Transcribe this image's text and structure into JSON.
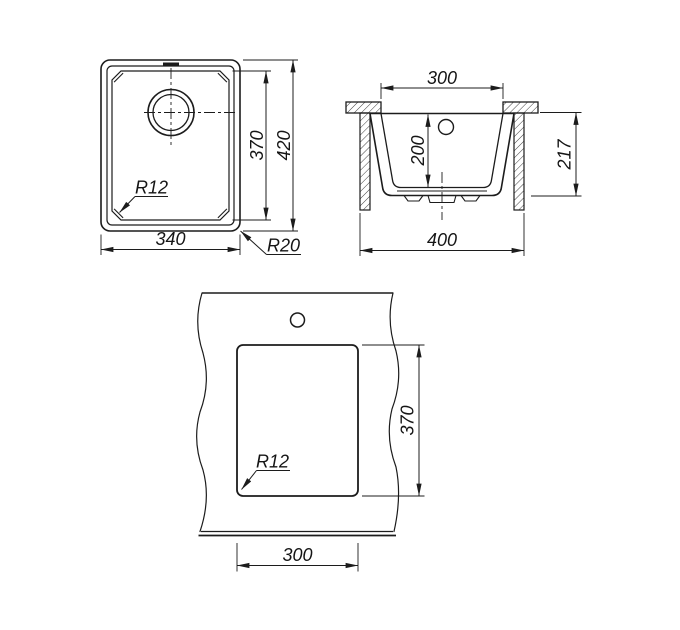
{
  "colors": {
    "background": "#ffffff",
    "line": "#1c1c1c"
  },
  "views": {
    "top": {
      "width": "340",
      "inner_height": "370",
      "height": "420",
      "inner_radius": "R12",
      "outer_radius": "R20"
    },
    "section": {
      "opening_width": "300",
      "bowl_depth": "200",
      "height": "217",
      "base_width": "400"
    },
    "cutout": {
      "width": "300",
      "height": "370",
      "corner_radius": "R12"
    }
  }
}
